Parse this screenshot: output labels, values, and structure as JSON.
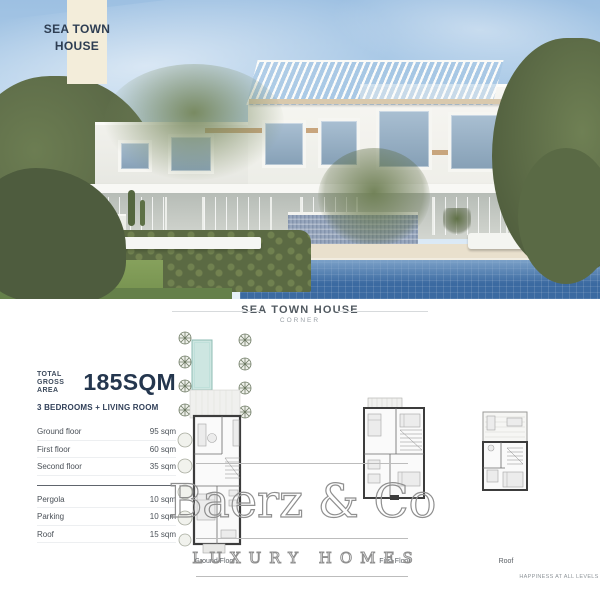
{
  "banner": {
    "line1": "SEA TOWN",
    "line2": "HOUSE"
  },
  "caption": {
    "title": "SEA TOWN HOUSE",
    "subtitle": "CORNER"
  },
  "info": {
    "total_label_line1": "TOTAL",
    "total_label_line2": "GROSS AREA",
    "total_value": "185SQM",
    "configuration": "3 BEDROOMS + LIVING ROOM",
    "floors": [
      {
        "label": "Ground floor",
        "value": "95 sqm"
      },
      {
        "label": "First floor",
        "value": "60 sqm"
      },
      {
        "label": "Second floor",
        "value": "35 sqm"
      }
    ],
    "extras": [
      {
        "label": "Pergola",
        "value": "10 sqm"
      },
      {
        "label": "Parking",
        "value": "10 sqm"
      },
      {
        "label": "Roof",
        "value": "15 sqm"
      }
    ]
  },
  "plans": {
    "ground_label": "Ground Floor",
    "first_label": "First Floor",
    "roof_label": "Roof"
  },
  "watermark": {
    "name": "Baerz & Co",
    "tagline": "LUXURY HOMES"
  },
  "footer": {
    "slogan": "HAPPINESS AT ALL LEVELS"
  },
  "icons": {
    "scene": "villa-render-illustration",
    "plans": [
      "ground-floor-plan-drawing",
      "first-floor-plan-drawing",
      "roof-plan-drawing"
    ]
  },
  "colors": {
    "banner_cream": "#f3edda",
    "navy_text": "#2e3e53",
    "sky_blue": "#9dc0e2",
    "pool_blue": "#3b6aa1",
    "foliage_green": "#5b6a43",
    "stone_wall_blue": "#97a6bd",
    "watermark_gray": "#8f8f8f"
  }
}
